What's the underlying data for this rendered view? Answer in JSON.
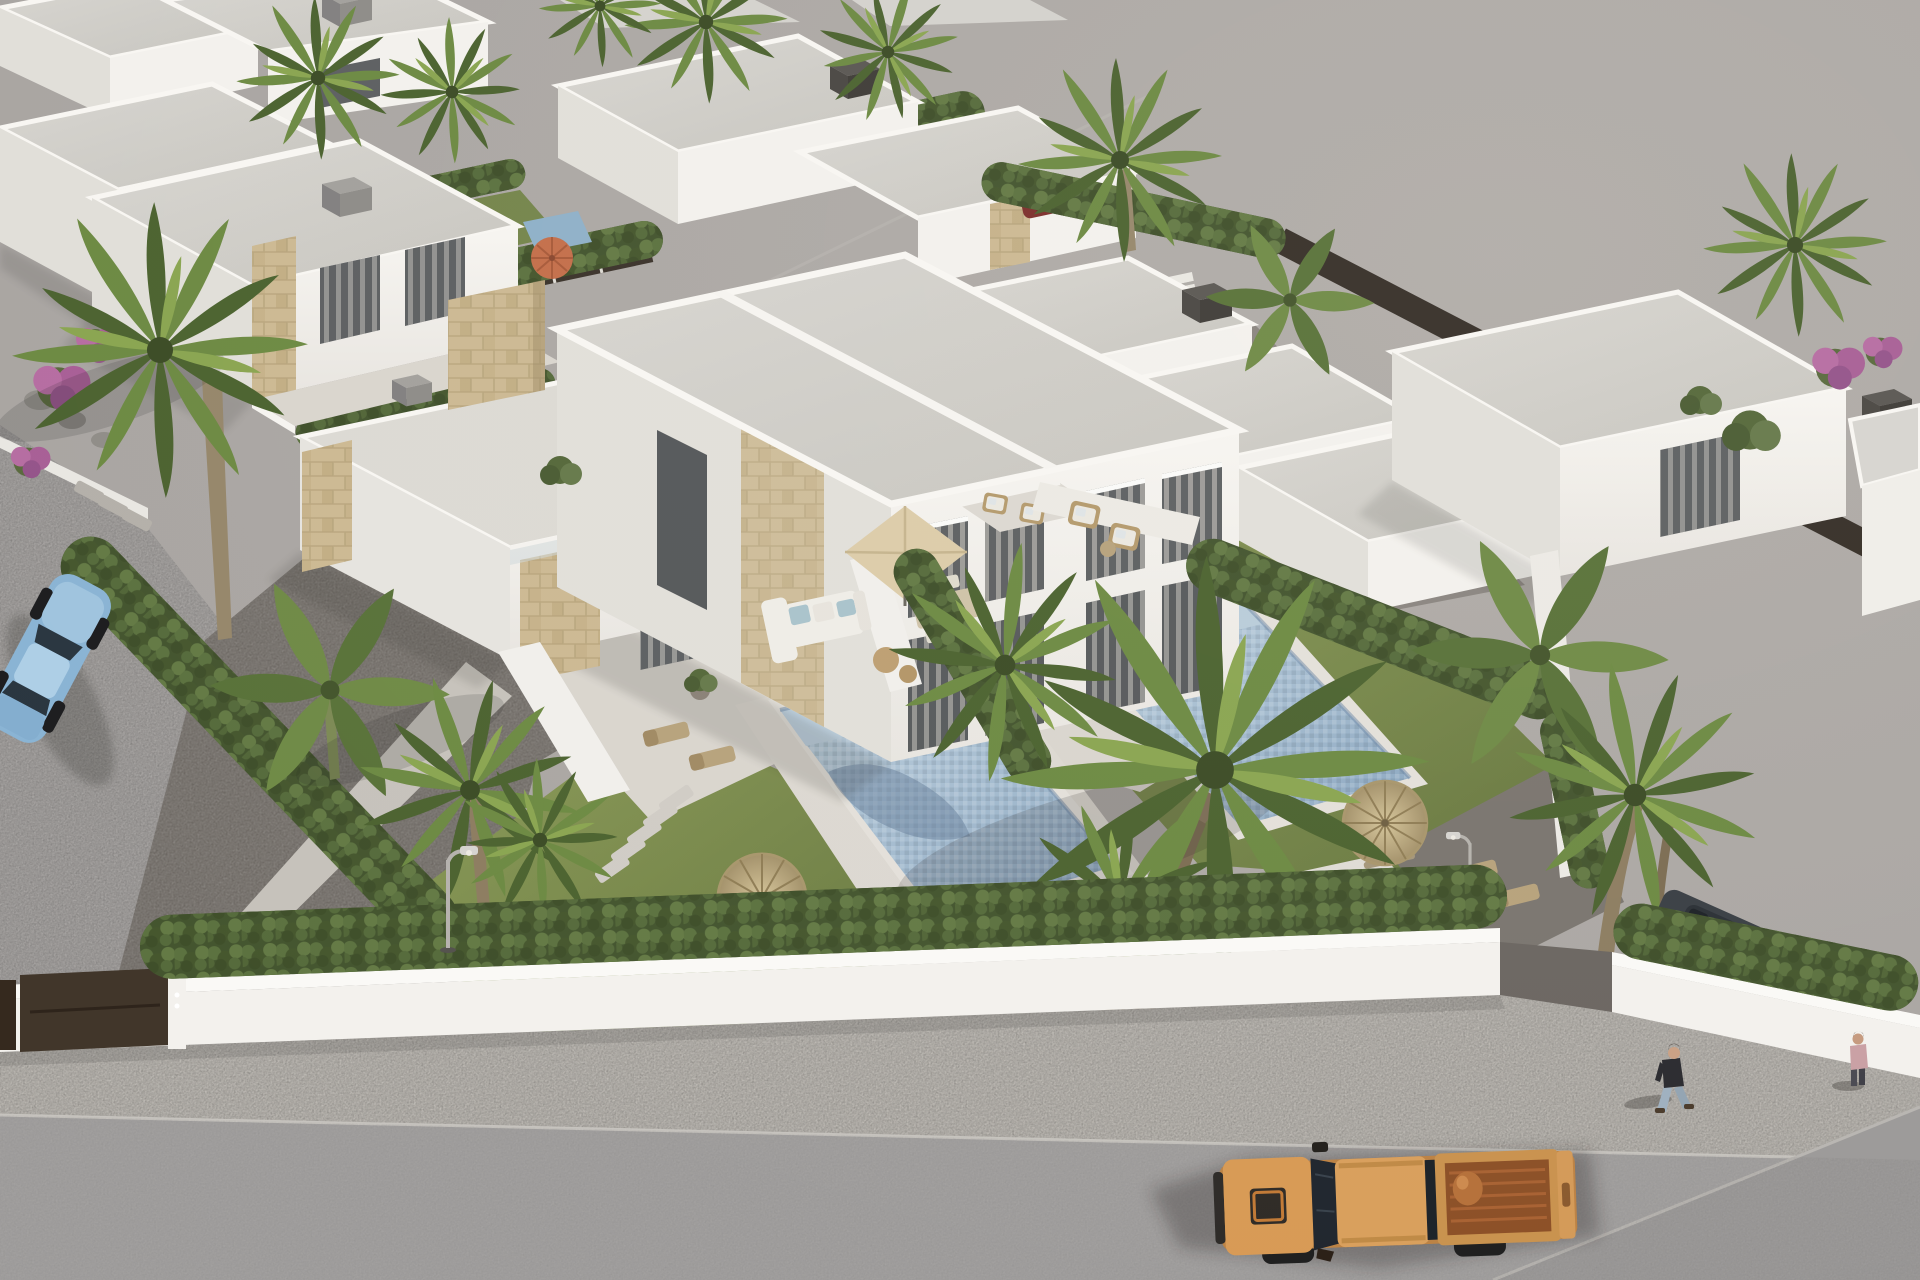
{
  "meta": {
    "domain": "Natural-Image",
    "description": "Aerial 3D architectural rendering of a modern Mediterranean villa development: white flat-roofed houses with beige stone accents, a central semi-detached villa with two mosaic swimming pools, tiled terraces with parasols and outdoor sofas, cypress hedges, palm trees, a white perimeter wall, a gravel sidewalk and asphalt street with an orange pickup truck, a parked blue sedan and pedestrians. Large empty grey plot at top right.",
    "style": "photorealistic CGI, isometric aerial daylight view"
  },
  "palette": {
    "ground": "#a8a4a1",
    "groundLight": "#b3afac",
    "street": "#a7a4a2",
    "road": "#a3a1a0",
    "roadDark": "#9c9a99",
    "sidewalk": "#b6b2ac",
    "wallWhite": "#f3f1ed",
    "wallLight": "#faf9f6",
    "wallShade": "#e1dfd9",
    "wallDark": "#cfccc6",
    "roofLight": "#d7d5d0",
    "roofDark": "#c8c6c0",
    "parapet": "#f8f6f2",
    "stone": "#ccb993",
    "stoneLine": "#b5a27a",
    "chimneyDark": "#504d49",
    "chimneyGray": "#9a9894",
    "fence": "#3b332b",
    "gate": "#41362a",
    "hedgeDark": "#44552f",
    "hedgeMid": "#5c7240",
    "hedgeLight": "#6d8349",
    "grass": "#7e8d52",
    "grassDark": "#606f41",
    "palmDark": "#4c6330",
    "palmMid": "#6d8a43",
    "palmLight": "#8aa551",
    "trunk": "#8d7d61",
    "gravel": "#6b6661",
    "gravelMid": "#8a8580",
    "path": "#c6c2bb",
    "tile": "#d9d5ce",
    "tileLight": "#dcd8d1",
    "poolBorder": "#e3e0da",
    "poolLight": "#c4d6e2",
    "poolDark": "#8ba7c2",
    "poolShadow": "#5f7894",
    "parasolBeige": "#dccca9",
    "straw": "#c4b288",
    "strawDark": "#8f7d55",
    "parasolOrange": "#c46f4b",
    "sofa": "#efede7",
    "cushion": "#a9c3cb",
    "wood": "#b7a27c",
    "rattan": "#b49a6d",
    "truckOrange": "#d89a55",
    "truckSide": "#bc8244",
    "truckBed": "#8c5027",
    "glass": "#20262e",
    "curtain": "#cfccc5",
    "windowDark": "#5d6062",
    "carBlue": "#8ab4d4",
    "carRoof": "#aecfe6",
    "carDark": "#3a3f45",
    "redCar": "#7c2f2c",
    "skin": "#caa184",
    "shirt": "#2b2b30",
    "jeans": "#9fb0bf",
    "shirt2": "#c9a0a4",
    "flower": "#a85f96",
    "rock": "#908d88",
    "shadow": "#23221f",
    "lamp": "#b5b2ad"
  },
  "scene": {
    "objects": [
      {
        "name": "empty-lot",
        "label": "Unbuilt grey plot, top right"
      },
      {
        "name": "central-villa",
        "label": "Semi-detached two-storey white villa with stone accents"
      },
      {
        "name": "pool-left",
        "label": "Mosaic swimming pool of left unit"
      },
      {
        "name": "pool-right",
        "label": "Mosaic swimming pool of right unit"
      },
      {
        "name": "terrace",
        "label": "Tiled terrace with outdoor sofa and dining set"
      },
      {
        "name": "parasol-beige",
        "label": "Square beige parasol over dining table"
      },
      {
        "name": "straw-parasols",
        "label": "Two round straw parasols on lawns"
      },
      {
        "name": "orange-parasol",
        "label": "Orange parasol in rear neighbour garden"
      },
      {
        "name": "neighbor-villas",
        "label": "Rows of white flat-roof villas with hedged gardens"
      },
      {
        "name": "staircases",
        "label": "External white staircases between right villas"
      },
      {
        "name": "perimeter-wall",
        "label": "White boundary wall with dark entrance gate"
      },
      {
        "name": "hedges",
        "label": "Cypress privacy hedges along boundaries"
      },
      {
        "name": "palm-trees",
        "label": "Fan palms and banana plants"
      },
      {
        "name": "bougainvillea",
        "label": "Purple flowering shrubs"
      },
      {
        "name": "pickup-truck",
        "label": "Orange double-cab pickup truck on street"
      },
      {
        "name": "blue-sedan",
        "label": "Light blue sedan parked on left street"
      },
      {
        "name": "red-car",
        "label": "Dark red car behind hedge, upper right"
      },
      {
        "name": "dark-car",
        "label": "Dark car behind hedge, lower right"
      },
      {
        "name": "pedestrian-1",
        "label": "Man in dark shirt walking on sidewalk"
      },
      {
        "name": "pedestrian-2",
        "label": "Second pedestrian at right edge"
      },
      {
        "name": "street-lamps",
        "label": "Curved street lamps"
      },
      {
        "name": "garden-steps",
        "label": "White garden steps, right plot"
      },
      {
        "name": "stepping-stones",
        "label": "Stepping stone paths"
      },
      {
        "name": "sidewalk",
        "label": "Gravel sidewalk"
      },
      {
        "name": "road",
        "label": "Asphalt street"
      }
    ]
  }
}
